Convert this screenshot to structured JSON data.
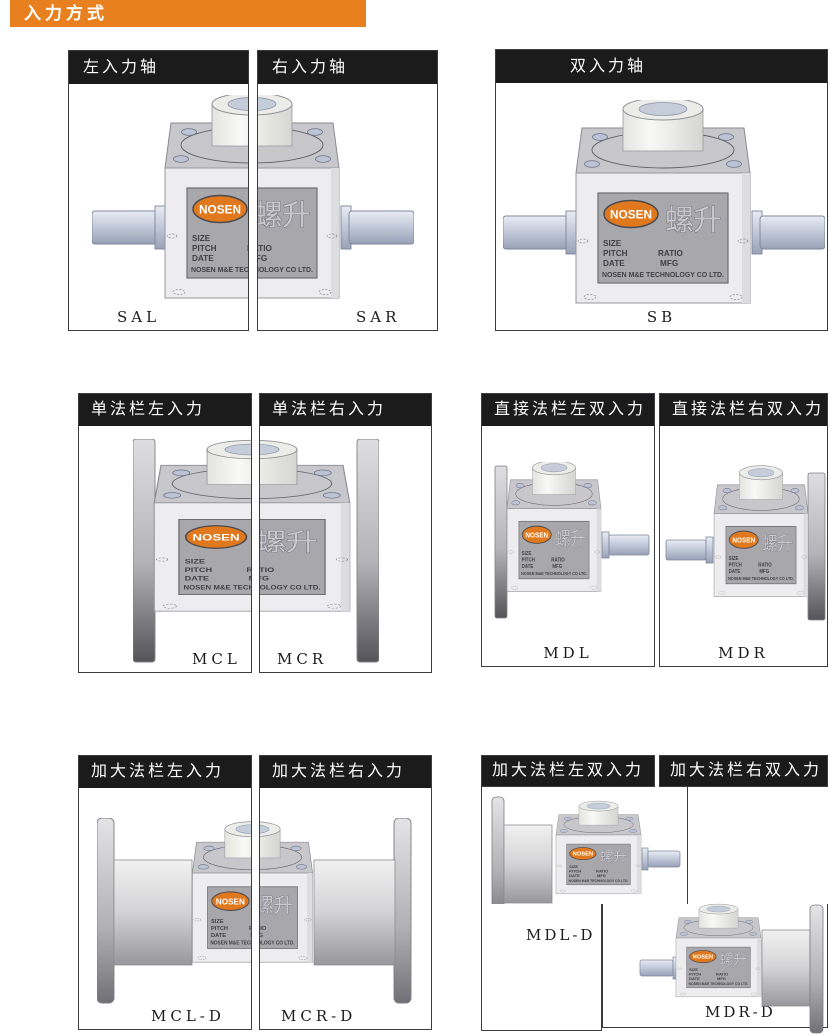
{
  "banner": {
    "text": "入力方式",
    "color": "#e8801f"
  },
  "panels": {
    "sal": {
      "title": "左入力轴",
      "model": "SAL"
    },
    "sar": {
      "title": "右入力轴",
      "model": "SAR"
    },
    "sb": {
      "title": "双入力轴",
      "model": "SB"
    },
    "mcl": {
      "title": "单法栏左入力",
      "model": "MCL"
    },
    "mcr": {
      "title": "单法栏右入力",
      "model": "MCR"
    },
    "mdl": {
      "title": "直接法栏左双入力",
      "model": "MDL"
    },
    "mdr": {
      "title": "直接法栏右双入力",
      "model": "MDR"
    },
    "mcld": {
      "title": "加大法栏左入力",
      "model": "MCL-D"
    },
    "mcrd": {
      "title": "加大法栏右入力",
      "model": "MCR-D"
    },
    "mdld": {
      "title": "加大法栏左双入力",
      "model": "MDL-D"
    },
    "mdrd": {
      "title": "加大法栏右双入力",
      "model": "MDR-D"
    }
  },
  "plate": {
    "brand": "NOSEN",
    "brand_cn": "螺升",
    "size": "SIZE",
    "pitch": "PITCH",
    "date": "DATE",
    "ratio": "RATIO",
    "mfg": "MFG",
    "company": "NOSEN M&E TECHNOLOGY CO LTD."
  },
  "colors": {
    "banner_orange": "#e8801f",
    "title_bar_black": "#1b1b1b",
    "logo_orange": "#e0791d",
    "plate_gray": "#a8a8ac",
    "body_gray": "#ededef",
    "shaft_blue_gray": "#c4cbdc"
  }
}
